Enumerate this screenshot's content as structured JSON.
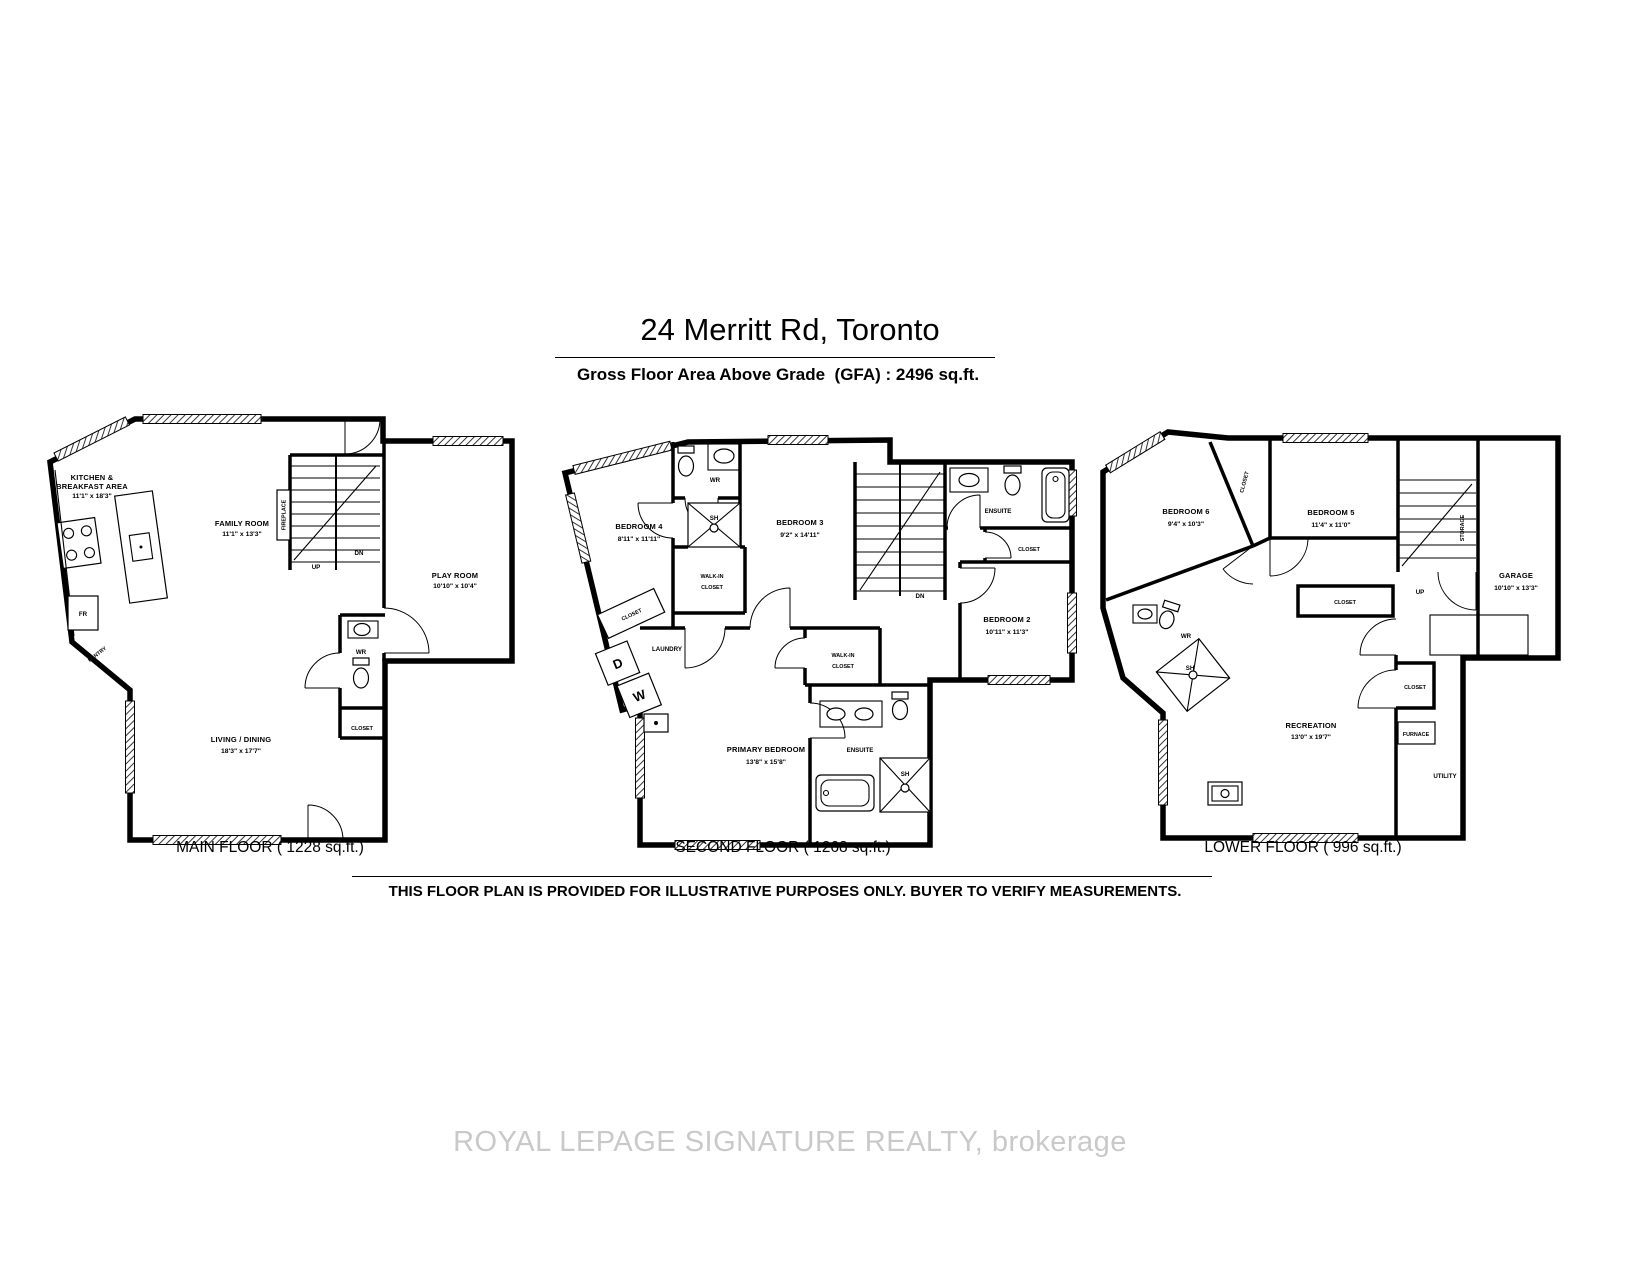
{
  "header": {
    "title": "24 Merritt Rd, Toronto",
    "subtitle": "Gross Floor Area Above Grade  (GFA) : 2496 sq.ft."
  },
  "floors": [
    {
      "id": "main",
      "caption": "MAIN FLOOR ( 1228 sq.ft.)",
      "labels": {
        "kitchen_1": "KITCHEN &",
        "kitchen_2": "BREAKFAST AREA",
        "kitchen_dims": "11'1\" x 18'3\"",
        "family": "FAMILY ROOM",
        "family_dims": "11'1\" x 13'3\"",
        "play": "PLAY ROOM",
        "play_dims": "10'10\" x 10'4\"",
        "living": "LIVING / DINING",
        "living_dims": "18'3\" x 17'7\"",
        "fireplace": "FIREPLACE",
        "pantry": "PANTRY",
        "fr": "FR",
        "wr": "WR",
        "closet": "CLOSET",
        "up": "UP",
        "dn": "DN"
      }
    },
    {
      "id": "second",
      "caption": "SECOND FLOOR ( 1268 sq.ft.)",
      "labels": {
        "bedroom4": "BEDROOM 4",
        "bedroom4_dims": "8'11\" x 11'11\"",
        "wr": "WR",
        "sh_top": "SH",
        "walkin_top_1": "WALK-IN",
        "walkin_top_2": "CLOSET",
        "bedroom3": "BEDROOM 3",
        "bedroom3_dims": "9'2\" x 14'11\"",
        "ensuite_top": "ENSUITE",
        "closet_top": "CLOSET",
        "bedroom2": "BEDROOM 2",
        "bedroom2_dims": "10'11\" x 11'3\"",
        "closet_left": "CLOSET",
        "laundry": "LAUNDRY",
        "d": "D",
        "w": "W",
        "primary": "PRIMARY BEDROOM",
        "primary_dims": "13'8\" x 15'8\"",
        "walkin_1": "WALK-IN",
        "walkin_2": "CLOSET",
        "ensuite": "ENSUITE",
        "sh": "SH",
        "dn": "DN"
      }
    },
    {
      "id": "lower",
      "caption": "LOWER FLOOR ( 996 sq.ft.)",
      "labels": {
        "bedroom6": "BEDROOM 6",
        "bedroom6_dims": "9'4\" x 10'3\"",
        "closet_b6": "CLOSET",
        "bedroom5": "BEDROOM 5",
        "bedroom5_dims": "11'4\" x 11'0\"",
        "storage": "STORAGE",
        "up": "UP",
        "garage": "GARAGE",
        "garage_dims": "10'10\" x 13'3\"",
        "wr": "WR",
        "sh": "SH",
        "closet_hall": "CLOSET",
        "closet_mid": "CLOSET",
        "furnace": "FURNACE",
        "utility": "UTILITY",
        "recreation": "RECREATION",
        "recreation_dims": "13'0\" x 19'7\""
      }
    }
  ],
  "footer": {
    "disclaimer": "THIS FLOOR PLAN IS PROVIDED FOR ILLUSTRATIVE PURPOSES ONLY. BUYER TO VERIFY MEASUREMENTS."
  },
  "watermark": "ROYAL LEPAGE SIGNATURE REALTY, brokerage",
  "colors": {
    "walls": "#000000",
    "watermark": "#c9c9c9"
  }
}
